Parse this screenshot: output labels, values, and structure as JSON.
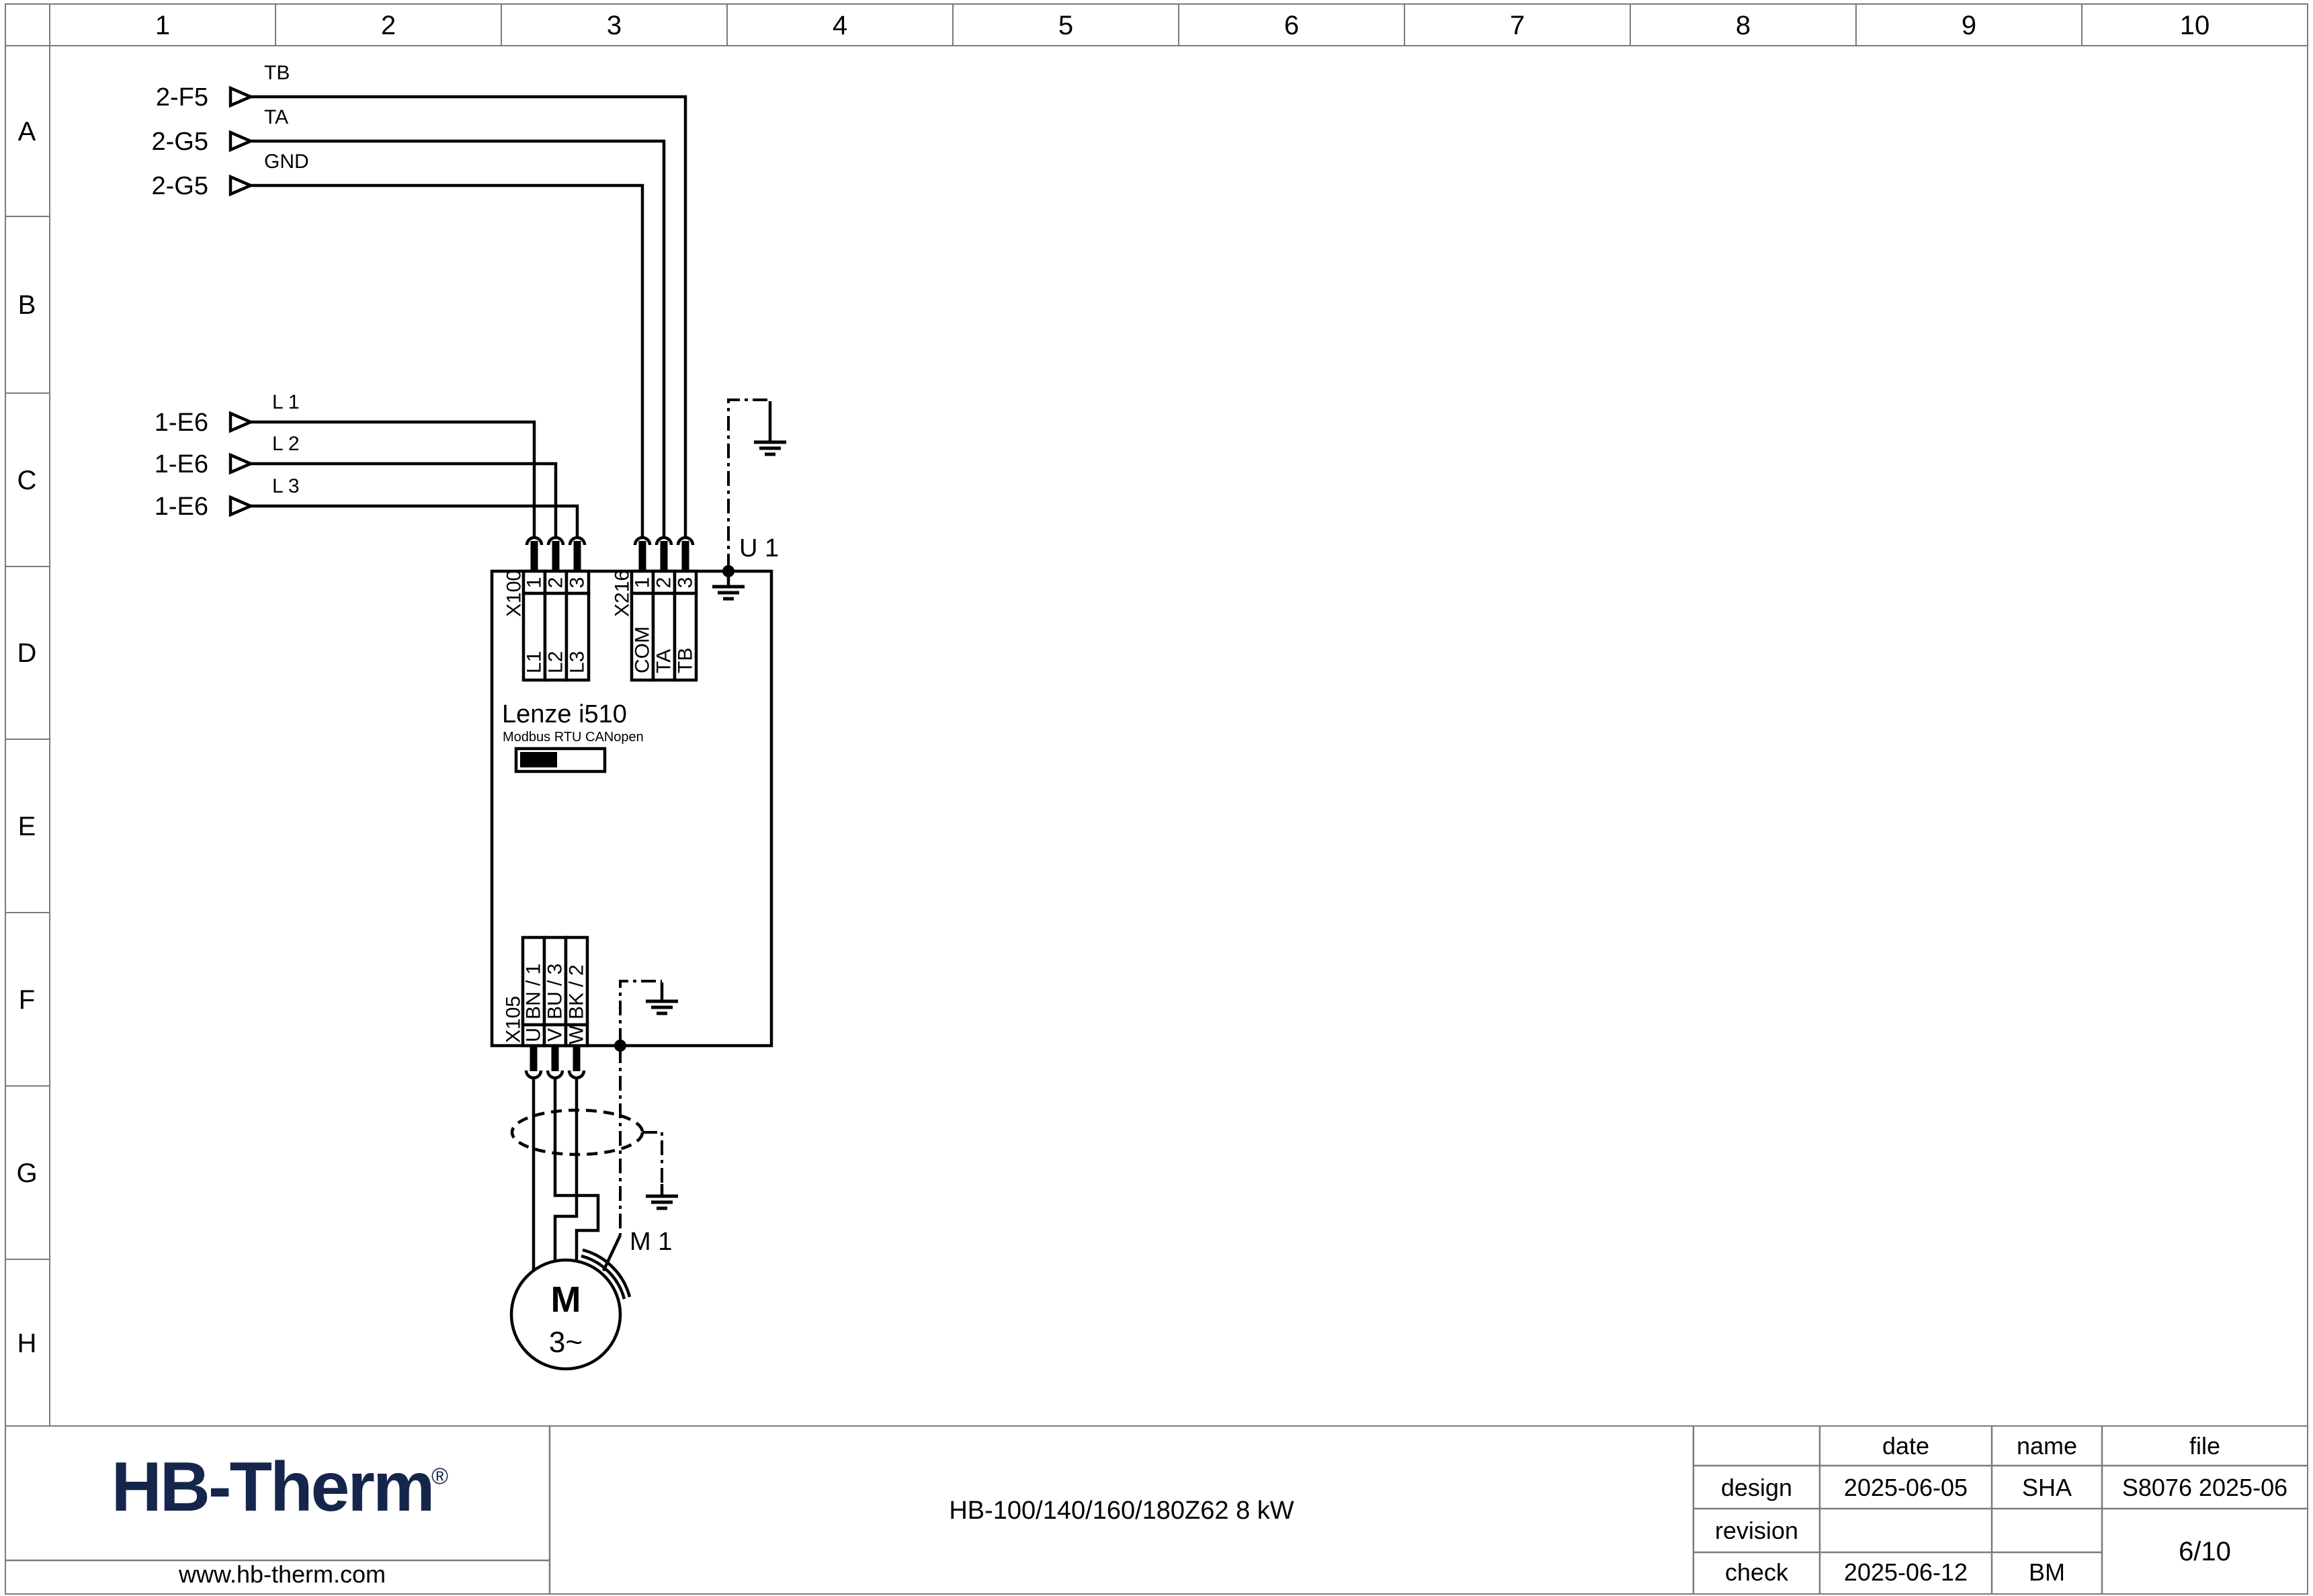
{
  "grid": {
    "cols": [
      "1",
      "2",
      "3",
      "4",
      "5",
      "6",
      "7",
      "8",
      "9",
      "10"
    ],
    "rows": [
      "A",
      "B",
      "C",
      "D",
      "E",
      "F",
      "G",
      "H"
    ]
  },
  "signals": {
    "top": [
      {
        "source": "2-F5",
        "label": "TB"
      },
      {
        "source": "2-G5",
        "label": "TA"
      },
      {
        "source": "2-G5",
        "label": "GND"
      }
    ],
    "power": [
      {
        "source": "1-E6",
        "label": "L 1"
      },
      {
        "source": "1-E6",
        "label": "L 2"
      },
      {
        "source": "1-E6",
        "label": "L 3"
      }
    ]
  },
  "drive": {
    "designator": "U 1",
    "model": "Lenze i510",
    "fieldbus": "Modbus RTU CANopen",
    "terminals": {
      "x100": {
        "name": "X100",
        "pins": [
          "1",
          "2",
          "3"
        ],
        "labels": [
          "L1",
          "L2",
          "L3"
        ]
      },
      "x216": {
        "name": "X216",
        "pins": [
          "1",
          "2",
          "3"
        ],
        "labels": [
          "COM",
          "TA",
          "TB"
        ]
      },
      "x105": {
        "name": "X105",
        "pins": [
          "U",
          "V",
          "W"
        ],
        "labels": [
          "BN / 1",
          "BU / 3",
          "BK / 2"
        ]
      }
    }
  },
  "motor": {
    "designator": "M 1",
    "letter": "M",
    "phase": "3~"
  },
  "titleblock": {
    "logo": "HB-Therm",
    "logo_reg": "®",
    "logo_color": "#16254b",
    "website": "www.hb-therm.com",
    "title": "HB-100/140/160/180Z62 8 kW",
    "table": {
      "header": {
        "date": "date",
        "name": "name",
        "file": "file"
      },
      "design": {
        "label": "design",
        "date": "2025-06-05",
        "name": "SHA",
        "file": "S8076 2025-06"
      },
      "revision": {
        "label": "revision",
        "date": "",
        "name": ""
      },
      "check": {
        "label": "check",
        "date": "2025-06-12",
        "name": "BM"
      },
      "page": "6/10"
    }
  }
}
